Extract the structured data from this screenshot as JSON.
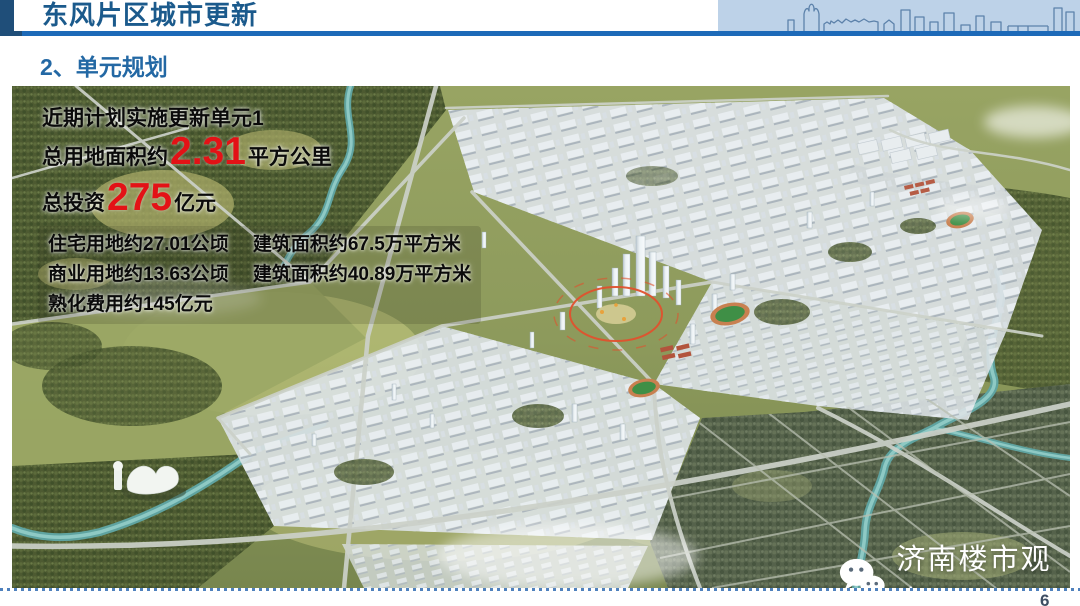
{
  "header": {
    "title": "东风片区城市更新"
  },
  "section": {
    "title": "2、单元规划"
  },
  "overlay": {
    "line1": "近期计划实施更新单元1",
    "area_prefix": "总用地面积约",
    "area_value": "2.31",
    "area_suffix": "平方公里",
    "invest_prefix": "总投资",
    "invest_value": "275",
    "invest_suffix": "亿元",
    "details": [
      "住宅用地约27.01公顷　 建筑面积约67.5万平方米",
      "商业用地约13.63公顷　 建筑面积约40.89万平方米",
      "熟化费用约145亿元"
    ],
    "highlight_color": "#e31216"
  },
  "watermark": {
    "icon": "wechat-icon",
    "text": "济南楼市观察"
  },
  "footer": {
    "page_number": "6"
  },
  "colors": {
    "header_navy": "#1f4e79",
    "header_bar_blue": "#1d6ab8",
    "title_blue": "#1b5a8c",
    "section_blue": "#2368a4",
    "skyline_bg": "#bdd2e8",
    "dotted_line_blue": "#4f81bd",
    "annotation_orange": "#e0512d"
  }
}
